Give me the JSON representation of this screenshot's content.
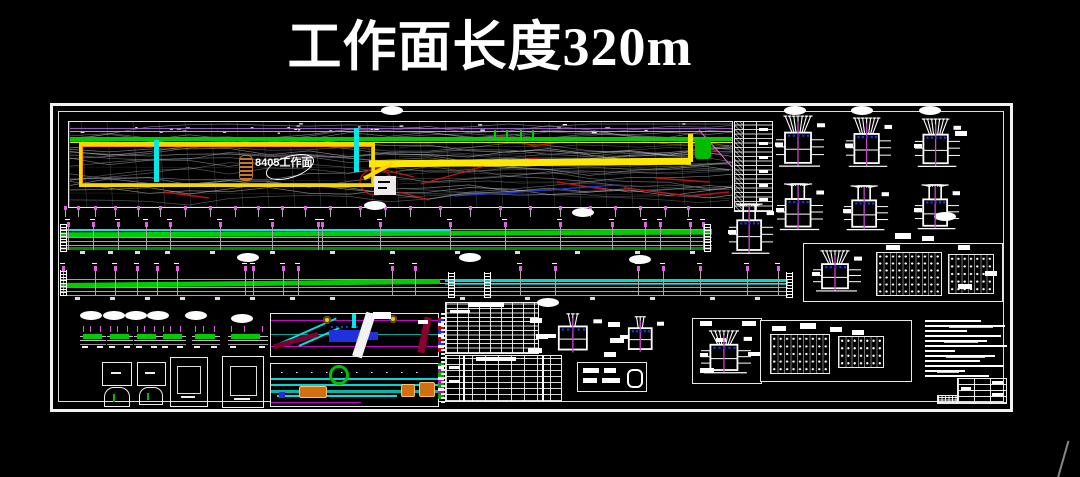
{
  "title": {
    "text": "工作面长度320m"
  },
  "plan": {
    "face_label": "8405工作面"
  },
  "colors": {
    "background": "#000000",
    "frame_white": "#f2f2f2",
    "contour_gray": "#b2b8bf",
    "grid_gray": "#8a9096",
    "roadway_yellow": "#f5e400",
    "roadway_orange": "#ff9000",
    "coal_green": "#00cc00",
    "dark_green": "#007a00",
    "crosscut_cyan": "#00e8e8",
    "teal_band": "#00c0b4",
    "dimension_magenta": "#e060e0",
    "violet_line": "#b266e6",
    "fault_red": "#cc1111",
    "water_blue": "#2233dd",
    "bolt_blue": "#2233cc",
    "maroon": "#7a0030",
    "equipment_orange": "#d07010",
    "pillar_orange": "#c87820"
  },
  "render_spec": {
    "contour_seed": 13,
    "plan_ticks_x": [
      65,
      78,
      95,
      115,
      138,
      160,
      185,
      210,
      235,
      258,
      282,
      305,
      330,
      360,
      385,
      410,
      440,
      470,
      500,
      530,
      560,
      590,
      615,
      640,
      665,
      688
    ],
    "band1": {
      "x": 60,
      "y": 222,
      "w": 652,
      "posts": [
        68,
        93,
        118,
        146,
        170,
        220,
        272,
        318,
        322,
        380,
        450,
        505,
        560,
        612,
        645,
        660,
        690,
        703
      ],
      "boxes": [
        80,
        108,
        135,
        165,
        210,
        270,
        330,
        390,
        455,
        515,
        575,
        635,
        690
      ]
    },
    "band2": {
      "x": 60,
      "y": 266,
      "w": 728,
      "posts": [
        63,
        95,
        115,
        137,
        157,
        177,
        245,
        253,
        283,
        298,
        392,
        415,
        520,
        555,
        638,
        663,
        700,
        747,
        778
      ],
      "boxes": [
        75,
        110,
        145,
        180,
        215,
        250,
        290,
        330,
        460,
        525,
        590,
        650,
        710,
        755
      ]
    },
    "rulers": [
      {
        "x": 60,
        "y": 224,
        "h": 28
      },
      {
        "x": 704,
        "y": 224,
        "h": 28
      },
      {
        "x": 60,
        "y": 270,
        "h": 26
      },
      {
        "x": 448,
        "y": 272,
        "h": 26
      },
      {
        "x": 484,
        "y": 272,
        "h": 26
      },
      {
        "x": 786,
        "y": 272,
        "h": 26
      }
    ],
    "ovals": [
      [
        392,
        110
      ],
      [
        375,
        205
      ],
      [
        583,
        212
      ],
      [
        945,
        216
      ],
      [
        248,
        257
      ],
      [
        470,
        257
      ],
      [
        640,
        259
      ],
      [
        548,
        302
      ],
      [
        795,
        110
      ],
      [
        862,
        110
      ],
      [
        930,
        110
      ],
      [
        91,
        315
      ],
      [
        114,
        315
      ],
      [
        136,
        315
      ],
      [
        158,
        315
      ],
      [
        196,
        315
      ],
      [
        242,
        318
      ]
    ],
    "callout_blobs": [
      [
        895,
        233,
        16,
        6
      ],
      [
        922,
        236,
        12,
        5
      ],
      [
        955,
        131,
        12,
        5
      ],
      [
        886,
        245,
        14,
        5
      ],
      [
        958,
        245,
        12,
        5
      ],
      [
        772,
        326,
        14,
        5
      ],
      [
        800,
        323,
        16,
        6
      ],
      [
        830,
        327,
        12,
        5
      ],
      [
        852,
        330,
        12,
        5
      ],
      [
        958,
        284,
        14,
        5
      ],
      [
        985,
        271,
        12,
        5
      ],
      [
        700,
        321,
        12,
        5
      ],
      [
        742,
        321,
        14,
        5
      ],
      [
        716,
        338,
        10,
        4
      ],
      [
        748,
        352,
        12,
        4
      ],
      [
        700,
        368,
        14,
        5
      ],
      [
        608,
        322,
        12,
        5
      ],
      [
        610,
        338,
        14,
        5
      ],
      [
        604,
        352,
        12,
        5
      ],
      [
        530,
        318,
        12,
        5
      ],
      [
        536,
        334,
        12,
        5
      ],
      [
        528,
        348,
        14,
        5
      ],
      [
        373,
        312,
        18,
        7
      ],
      [
        418,
        320,
        10,
        4
      ]
    ],
    "support_details": [
      {
        "x": 775,
        "y": 115,
        "w": 50,
        "h": 55,
        "v": 1
      },
      {
        "x": 845,
        "y": 117,
        "w": 47,
        "h": 53,
        "v": 1
      },
      {
        "x": 914,
        "y": 118,
        "w": 47,
        "h": 52,
        "v": 1
      },
      {
        "x": 776,
        "y": 183,
        "w": 48,
        "h": 50,
        "v": 2
      },
      {
        "x": 843,
        "y": 185,
        "w": 46,
        "h": 48,
        "v": 2
      },
      {
        "x": 914,
        "y": 184,
        "w": 46,
        "h": 48,
        "v": 2
      },
      {
        "x": 728,
        "y": 203,
        "w": 46,
        "h": 54,
        "v": 2
      },
      {
        "x": 548,
        "y": 313,
        "w": 54,
        "h": 42,
        "v": 3
      },
      {
        "x": 620,
        "y": 316,
        "w": 44,
        "h": 38,
        "v": 3
      },
      {
        "x": 700,
        "y": 330,
        "w": 52,
        "h": 46,
        "v": 1
      },
      {
        "x": 812,
        "y": 250,
        "w": 50,
        "h": 44,
        "v": 1
      }
    ],
    "meshes": [
      {
        "x": 876,
        "y": 252,
        "w": 64,
        "h": 42,
        "c": 10,
        "r": 6
      },
      {
        "x": 948,
        "y": 254,
        "w": 44,
        "h": 38,
        "c": 7,
        "r": 5
      },
      {
        "x": 770,
        "y": 334,
        "w": 58,
        "h": 38,
        "c": 9,
        "r": 5
      },
      {
        "x": 838,
        "y": 336,
        "w": 44,
        "h": 30,
        "c": 7,
        "r": 4
      }
    ],
    "mini_sections": [
      {
        "x": 80,
        "w": 26
      },
      {
        "x": 107,
        "w": 26
      },
      {
        "x": 134,
        "w": 26
      },
      {
        "x": 160,
        "w": 26
      },
      {
        "x": 192,
        "w": 28
      },
      {
        "x": 228,
        "w": 40
      }
    ],
    "mini_y": 324,
    "notes": {
      "x": 925,
      "y": 320,
      "step": 5,
      "widths": [
        56,
        80,
        42,
        76,
        62,
        82,
        30,
        70,
        55,
        78,
        40,
        64
      ]
    },
    "plan_lines": {
      "red": [
        [
          [
            352,
            62
          ],
          [
            430,
            40
          ],
          [
            470,
            36
          ]
        ],
        [
          [
            430,
            14
          ],
          [
            465,
            24
          ],
          [
            505,
            18
          ]
        ],
        [
          [
            300,
            44
          ],
          [
            345,
            55
          ]
        ],
        [
          [
            555,
            66
          ],
          [
            620,
            74
          ],
          [
            660,
            70
          ]
        ],
        [
          [
            586,
            56
          ],
          [
            640,
            60
          ]
        ],
        [
          [
            488,
            60
          ],
          [
            540,
            68
          ]
        ],
        [
          [
            620,
            20
          ],
          [
            650,
            30
          ]
        ],
        [
          [
            330,
            70
          ],
          [
            360,
            78
          ]
        ],
        [
          [
            95,
            70
          ],
          [
            140,
            76
          ]
        ]
      ],
      "red_ellipse": {
        "cx": 307,
        "cy": 60,
        "rx": 16,
        "ry": 13
      },
      "blue": [
        [
          [
            385,
            74
          ],
          [
            450,
            70
          ],
          [
            548,
            63
          ]
        ]
      ],
      "magenta": [
        [
          [
            630,
            8
          ],
          [
            663,
            45
          ]
        ]
      ]
    }
  }
}
